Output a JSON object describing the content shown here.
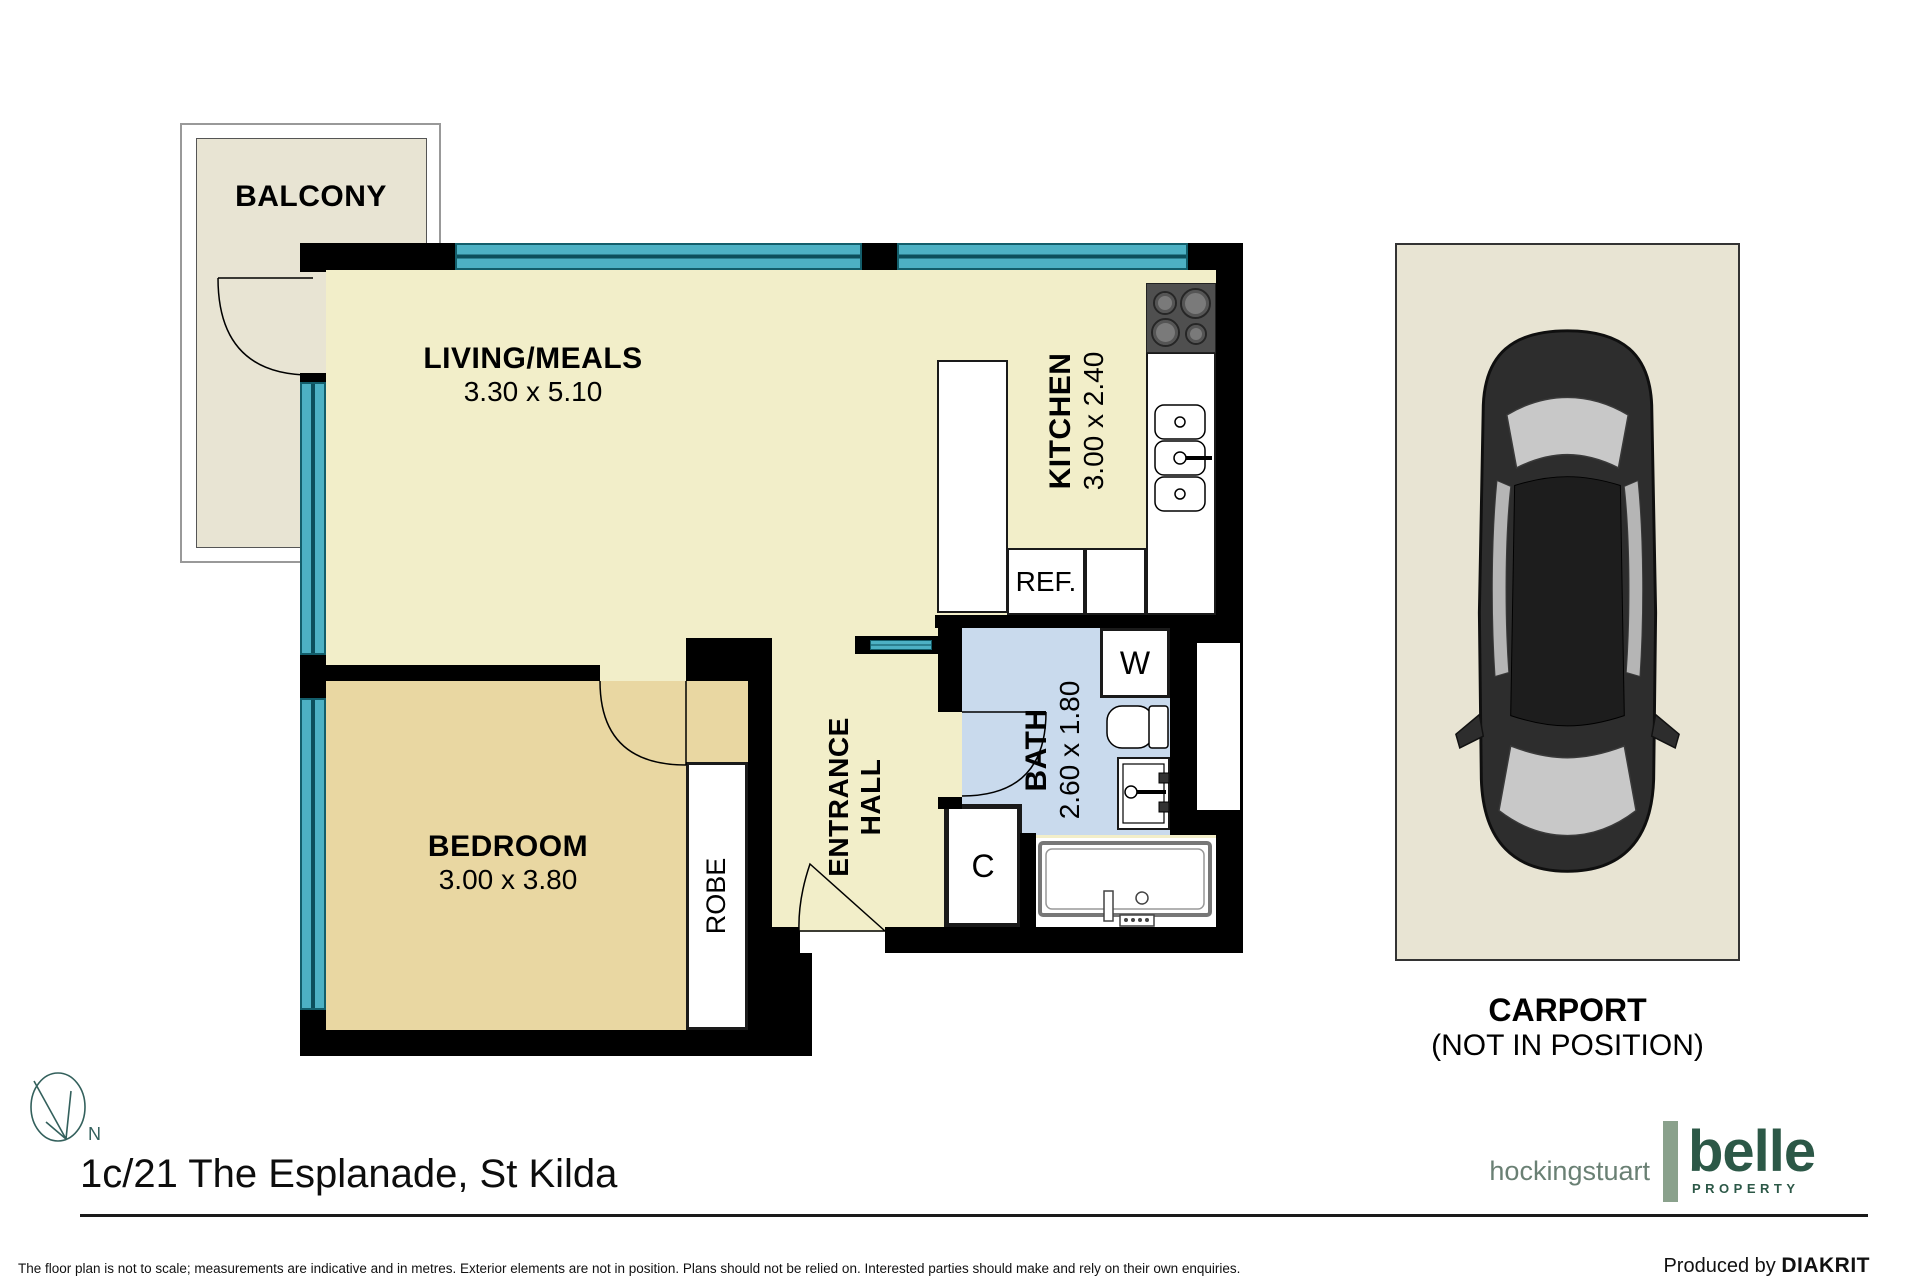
{
  "floorplan": {
    "rooms": {
      "balcony": {
        "label": "BALCONY"
      },
      "living": {
        "label": "LIVING/MEALS",
        "dims": "3.30 x 5.10"
      },
      "kitchen": {
        "label": "KITCHEN",
        "dims": "3.00 x 2.40"
      },
      "bedroom": {
        "label": "BEDROOM",
        "dims": "3.00 x 3.80"
      },
      "bath": {
        "label": "BATH",
        "dims": "2.60 x 1.80"
      },
      "entrance_hall": {
        "line1": "ENTRANCE",
        "line2": "HALL"
      },
      "robe": {
        "label": "ROBE"
      },
      "carport": {
        "label": "CARPORT",
        "sublabel": "(NOT IN POSITION)"
      }
    },
    "fixtures": {
      "fridge": "REF.",
      "washer": "W",
      "cupboard": "C"
    },
    "compass": {
      "north": "N"
    }
  },
  "footer": {
    "address": "1c/21 The Esplanade, St Kilda",
    "disclaimer": "The floor plan is not to scale; measurements are indicative and in metres. Exterior elements are not in position. Plans should not be relied on. Interested parties should make and rely on their own enquiries.",
    "produced_by": "Produced by",
    "producer": "DIAKRIT"
  },
  "branding": {
    "agency1": "hockingstuart",
    "agency2": "belle",
    "agency2_sub": "PROPERTY"
  },
  "colors": {
    "living_floor": "#f2eec9",
    "bedroom_floor": "#e9d7a2",
    "bath_floor": "#c9daed",
    "exterior_floor": "#e8e4d3",
    "window_teal": "#4db1c4",
    "wall_black": "#000000",
    "brand_green": "#2c5847",
    "brand_sage": "#8aa18c",
    "brand_gray_green": "#6a8074"
  }
}
